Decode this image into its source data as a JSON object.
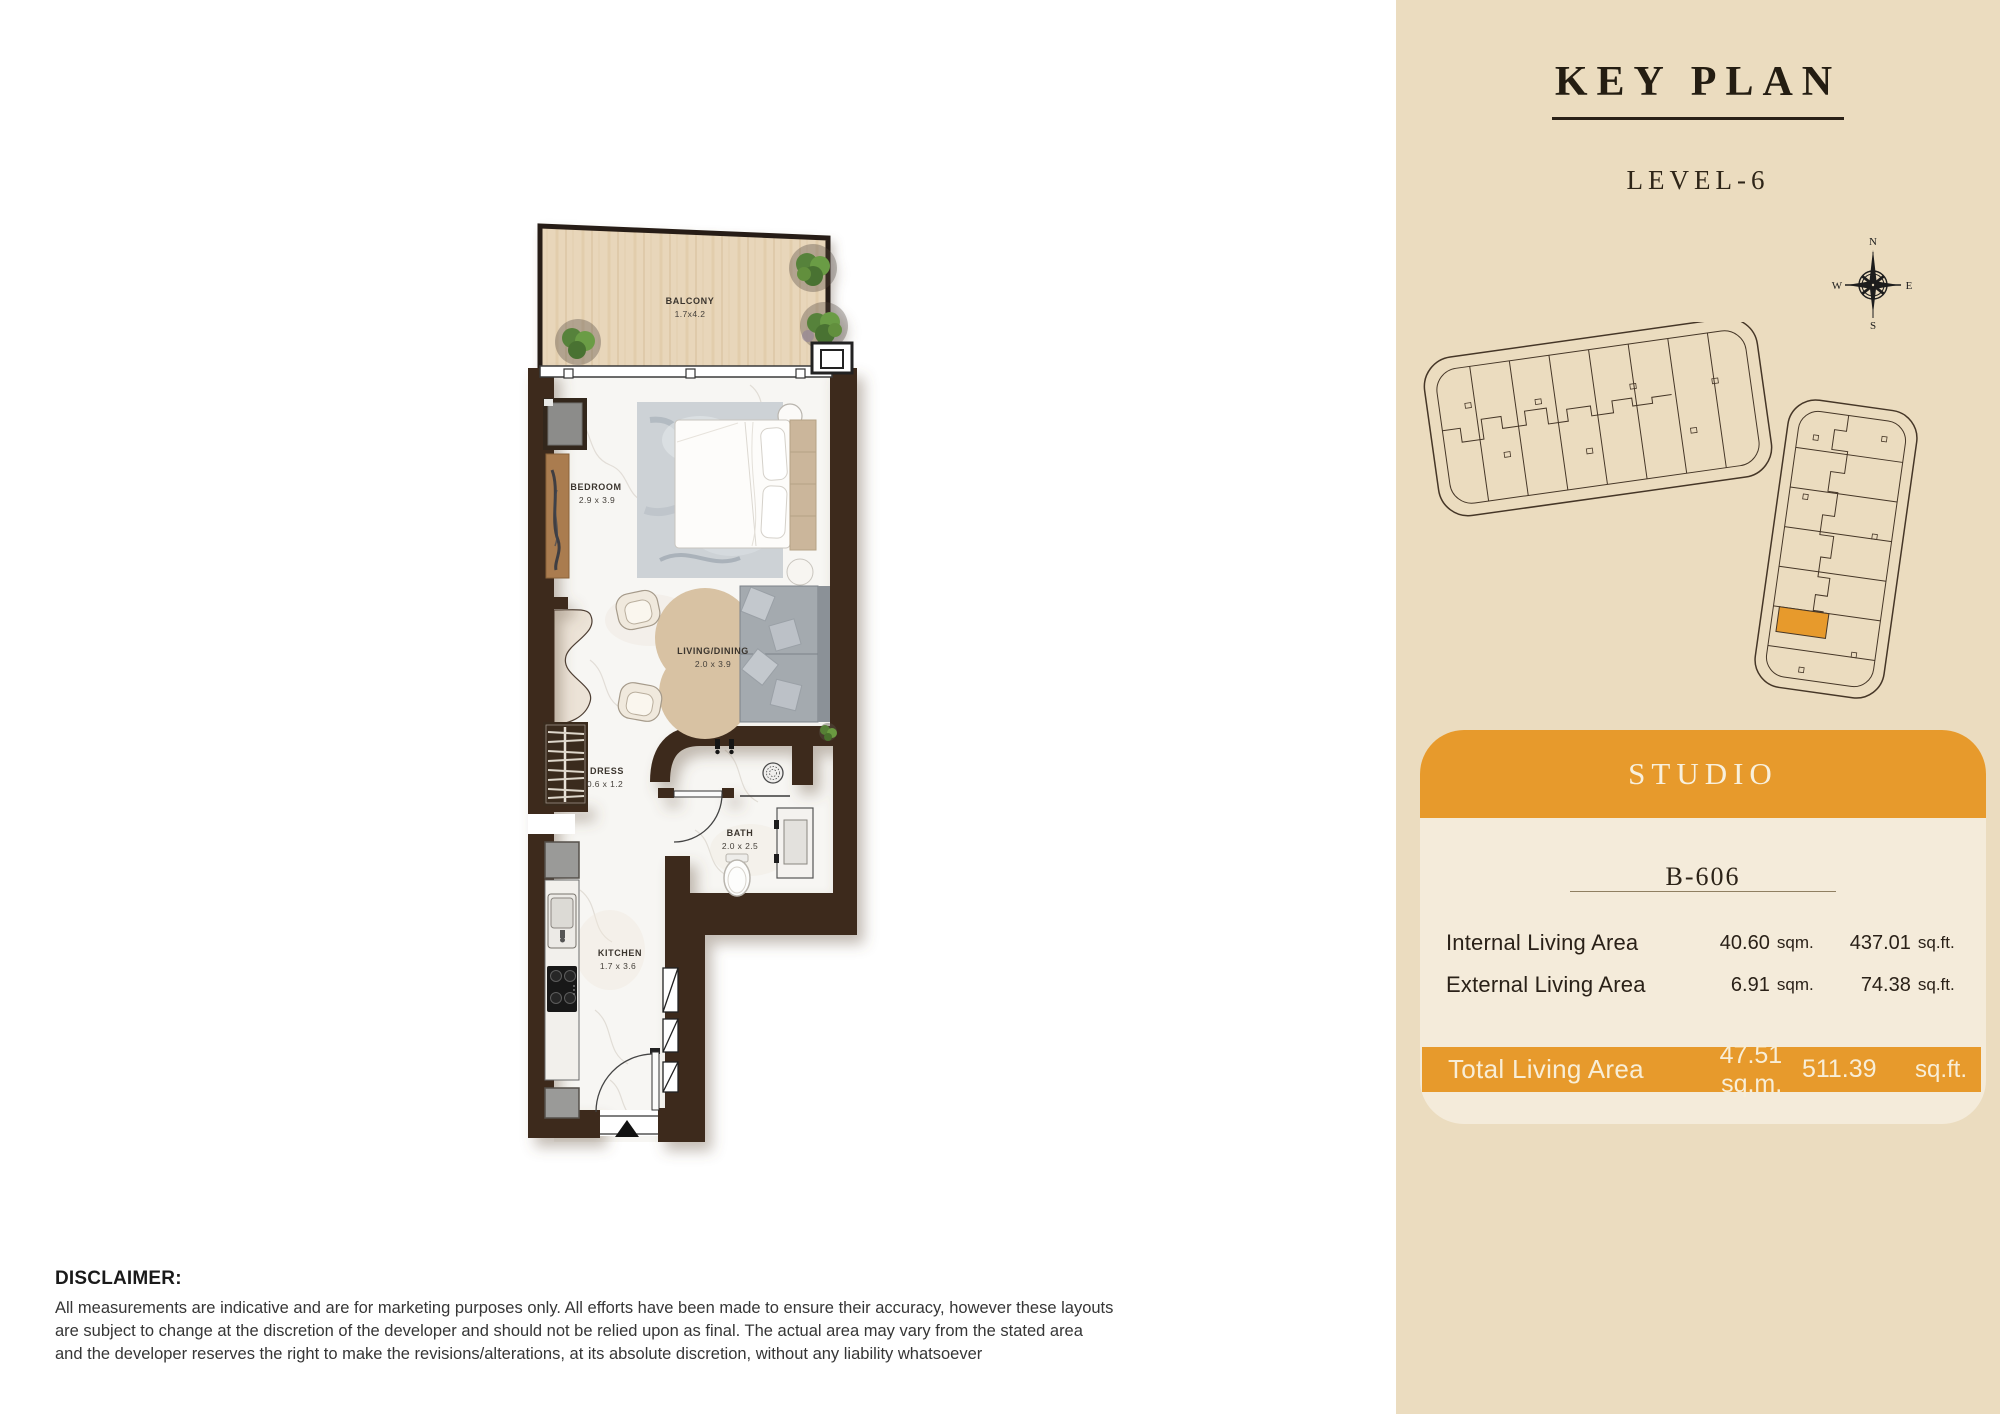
{
  "plan": {
    "rooms": [
      {
        "name": "BALCONY",
        "dims": "1.7x4.2"
      },
      {
        "name": "BEDROOM",
        "dims": "2.9 x 3.9"
      },
      {
        "name": "LIVING/DINING",
        "dims": "2.0 x 3.9"
      },
      {
        "name": "DRESS",
        "dims": "0.6 x 1.2"
      },
      {
        "name": "BATH",
        "dims": "2.0 x 2.5"
      },
      {
        "name": "KITCHEN",
        "dims": "1.7 x 3.6"
      }
    ]
  },
  "sidebar": {
    "title": "KEY PLAN",
    "level": "LEVEL-6",
    "compass": {
      "n": "N",
      "e": "E",
      "s": "S",
      "w": "W"
    },
    "card": {
      "type": "STUDIO",
      "unit": "B-606",
      "rows": [
        {
          "label": "Internal Living Area",
          "sqm": "40.60",
          "sqm_unit": "sqm.",
          "sqft": "437.01",
          "sqft_unit": "sq.ft."
        },
        {
          "label": "External Living Area",
          "sqm": "6.91",
          "sqm_unit": "sqm.",
          "sqft": "74.38",
          "sqft_unit": "sq.ft."
        }
      ],
      "total": {
        "label": "Total Living Area",
        "sqm": "47.51 sq.m.",
        "sqft": "511.39",
        "sqft_unit": "sq.ft."
      }
    }
  },
  "disclaimer": {
    "title": "DISCLAIMER:",
    "lines": [
      "All measurements are indicative and are for marketing purposes only. All efforts have been made to ensure their accuracy, however these layouts",
      "are subject to change at the discretion of the developer and should not be relied upon as final. The actual area may vary from the stated area",
      "and the developer reserves the right to make the revisions/alterations, at its absolute discretion, without any liability whatsoever"
    ]
  },
  "colors": {
    "panel": "#EBDCBF",
    "card": "#F4EBDA",
    "accent": "#E79A2C",
    "wall": "#3E2C1E"
  }
}
